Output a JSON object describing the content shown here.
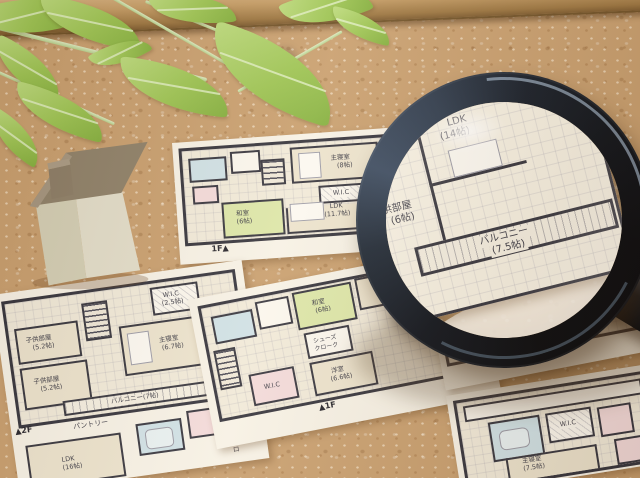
{
  "scene": {
    "subject": "Japanese house floor-plan sheets pinned on a cork board with a magnifying glass, a miniature house model and artificial green leaves"
  },
  "colors": {
    "cork": "#c89f6f",
    "wood_frame": "#b78e57",
    "leaf_green": "#9cc553",
    "paper": "#f7f3e8",
    "plan_wall": "#32323c",
    "tatami_green": "#dce7a9",
    "bath_blue": "#cfe2e8",
    "closet_pink": "#f3dbdc",
    "magnifier_rim": "#0c121d",
    "house_body": "#e2decb",
    "house_roof": "#8d8069"
  },
  "plan_a": {
    "floor_label": "1F▲",
    "next_page_label": "2F",
    "master_name": "主寝室",
    "master_size": "(8帖)",
    "wic": "W.I.C",
    "ldk_name": "LDK",
    "ldk_size": "(11.7帖)",
    "washitsu_name": "和室",
    "washitsu_size": "(6帖)"
  },
  "lens_plan": {
    "ldk_name": "LDK",
    "ldk_size": "(14帖)",
    "kids_name": "子供部屋",
    "kids_size": "(6帖)",
    "partial_name": "部屋",
    "partial_size": "(帖)",
    "balcony_name": "バルコニー",
    "balcony_size": "(7.5帖)"
  },
  "plan_b": {
    "floor_label": "▲2F",
    "wic_name": "W.I.C",
    "wic_size": "(2.5帖)",
    "kids1_name": "子供部屋",
    "kids1_size": "(5.2帖)",
    "master_name": "主寝室",
    "master_size": "(6.7帖)",
    "kids2_name": "子供部屋",
    "kids2_size": "(5.2帖)",
    "balcony": "バルコニー(7帖)",
    "pantry": "パントリー",
    "ldk_name": "LDK",
    "ldk_size": "(16帖)",
    "shoes_closet_vertical": "シューズクロ"
  },
  "plan_c": {
    "floor_label": "▲1F",
    "washitsu_name": "和室",
    "washitsu_size": "(6帖)",
    "cloak_line1": "シューズ",
    "cloak_line2": "クローク",
    "youshitsu_name": "洋室",
    "youshitsu_size": "(6.6帖)",
    "wic": "W.I.C"
  },
  "plan_d": {
    "floor_label_2f": "▲2F",
    "floor_label_3f": "▲3F",
    "wic": "W.I.C",
    "master_name": "主寝室",
    "master_size": "(8帖)"
  },
  "plan_e": {
    "wic": "W.I.C",
    "master_name": "主寝室",
    "master_size": "(7.5帖)"
  }
}
